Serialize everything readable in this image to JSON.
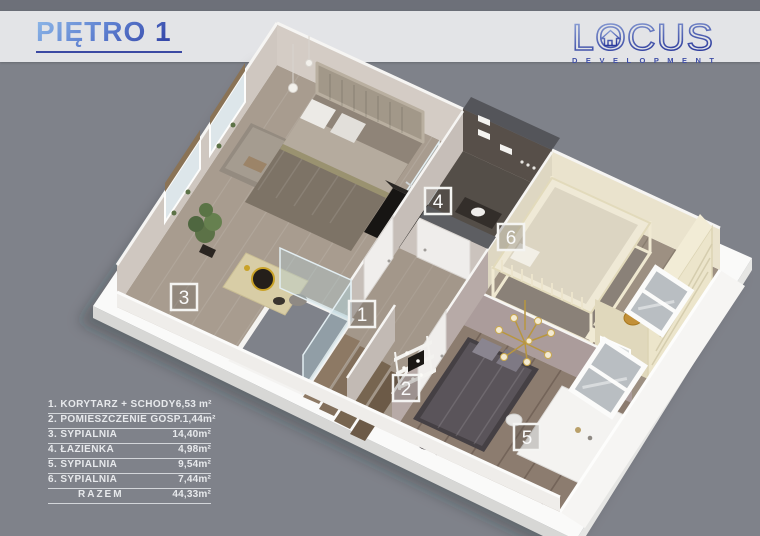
{
  "page": {
    "background": "#7f828a",
    "top_strip": "#6d7079",
    "band": "#e3e4e7"
  },
  "header": {
    "title": "PIĘTRO 1",
    "accent": "#27339b"
  },
  "logo": {
    "word": "LOCUS",
    "subtitle": "D E V E L O P M E N T",
    "color": "#3b49a3"
  },
  "legend": {
    "rows": [
      {
        "label": "1. KORYTARZ + SCHODY",
        "area": "6,53 m²"
      },
      {
        "label": "2. POMIESZCZENIE GOSP.",
        "area": "1,44m²"
      },
      {
        "label": "3. SYPIALNIA",
        "area": "14,40m²"
      },
      {
        "label": "4. ŁAZIENKA",
        "area": "4,98m²"
      },
      {
        "label": "5. SYPIALNIA",
        "area": "9,54m²"
      },
      {
        "label": "6. SYPIALNIA",
        "area": "7,44m²"
      }
    ],
    "total": {
      "label": "RAZEM",
      "area": "44,33m²"
    }
  },
  "markers": [
    "1",
    "2",
    "3",
    "4",
    "5",
    "6"
  ]
}
